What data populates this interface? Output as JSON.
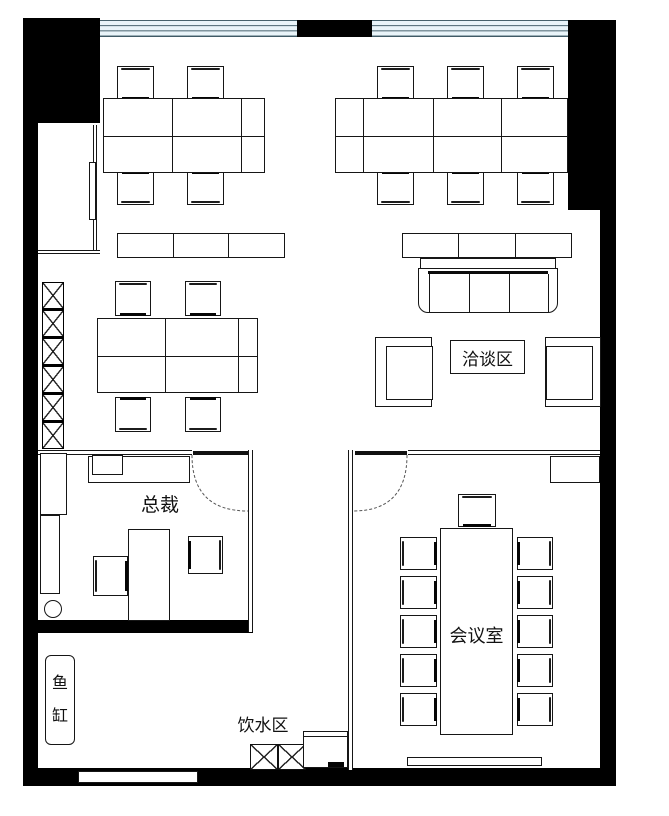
{
  "floor_plan": {
    "rooms": {
      "negotiation_area": {
        "label": "洽谈区"
      },
      "ceo_office": {
        "label": "总裁"
      },
      "meeting_room": {
        "label": "会议室"
      },
      "water_area": {
        "label": "饮水区"
      },
      "fish_tank": {
        "label": "鱼缸"
      }
    },
    "colors": {
      "wall": "#000000",
      "line": "#161616",
      "window_fill": "#e9f4f9",
      "window_line": "#3f5a66",
      "background": "#ffffff"
    }
  }
}
